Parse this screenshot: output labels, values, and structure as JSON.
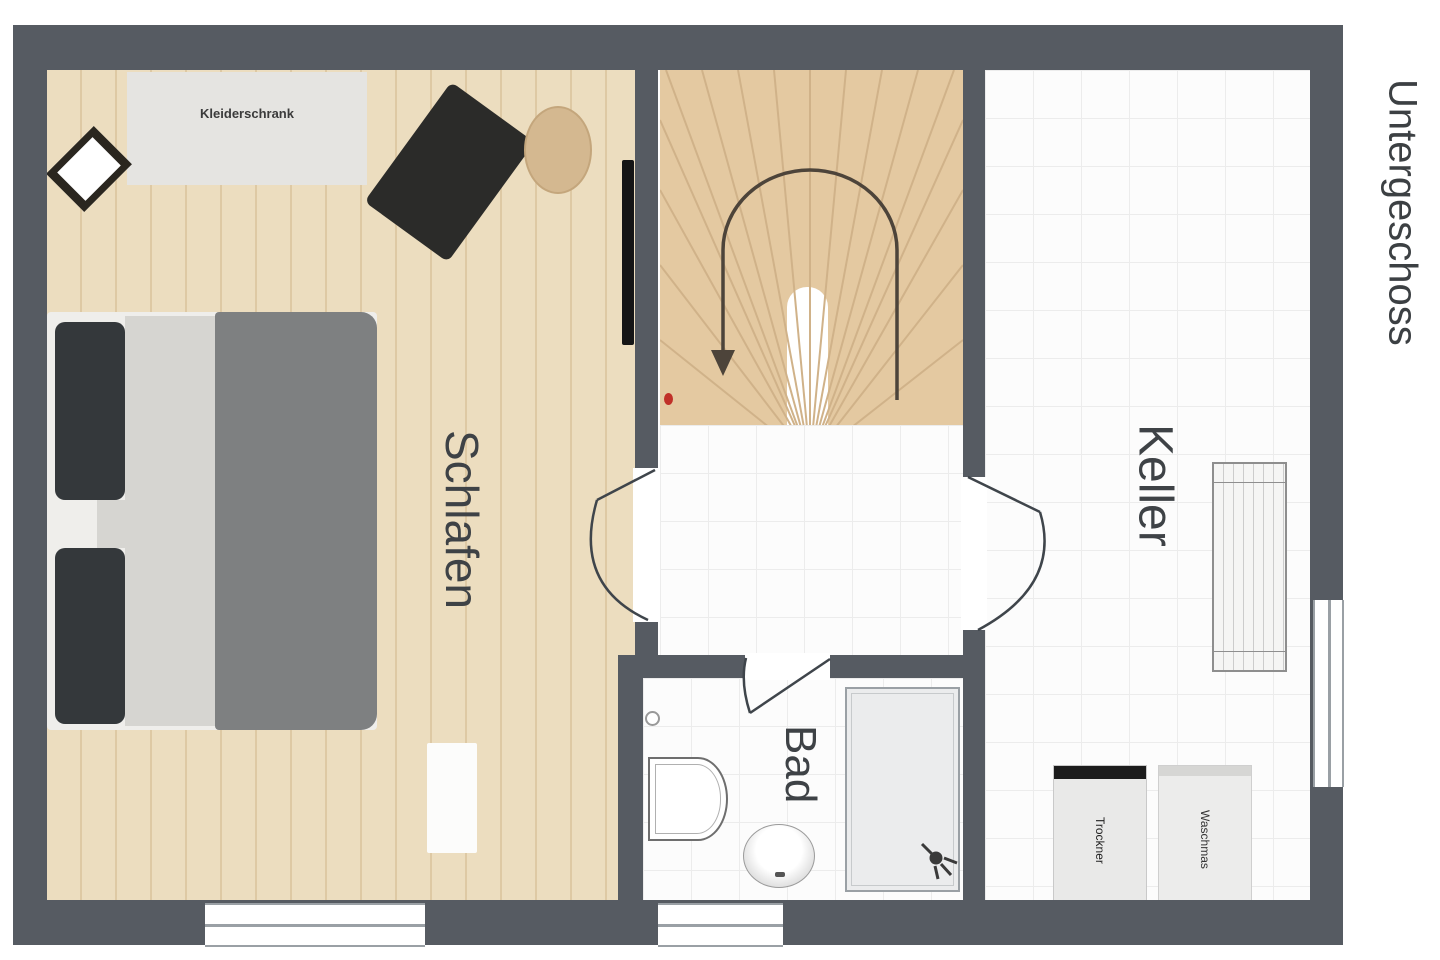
{
  "title": {
    "text": "Untergeschoss"
  },
  "rooms": {
    "schlafen": "Schlafen",
    "bad": "Bad",
    "keller": "Keller"
  },
  "labels": {
    "wardrobe": "Kleiderschrank",
    "dryer": "Trockner",
    "washer": "Waschmas"
  },
  "colors": {
    "wall": "#565b62",
    "wood_floor": "#eadcbc",
    "stair_wood": "#e4c9a1",
    "tile_floor": "#fcfcfc",
    "bed_blanket": "#7e8081",
    "marker_red": "#c03028",
    "text_dark": "#3e4246"
  }
}
